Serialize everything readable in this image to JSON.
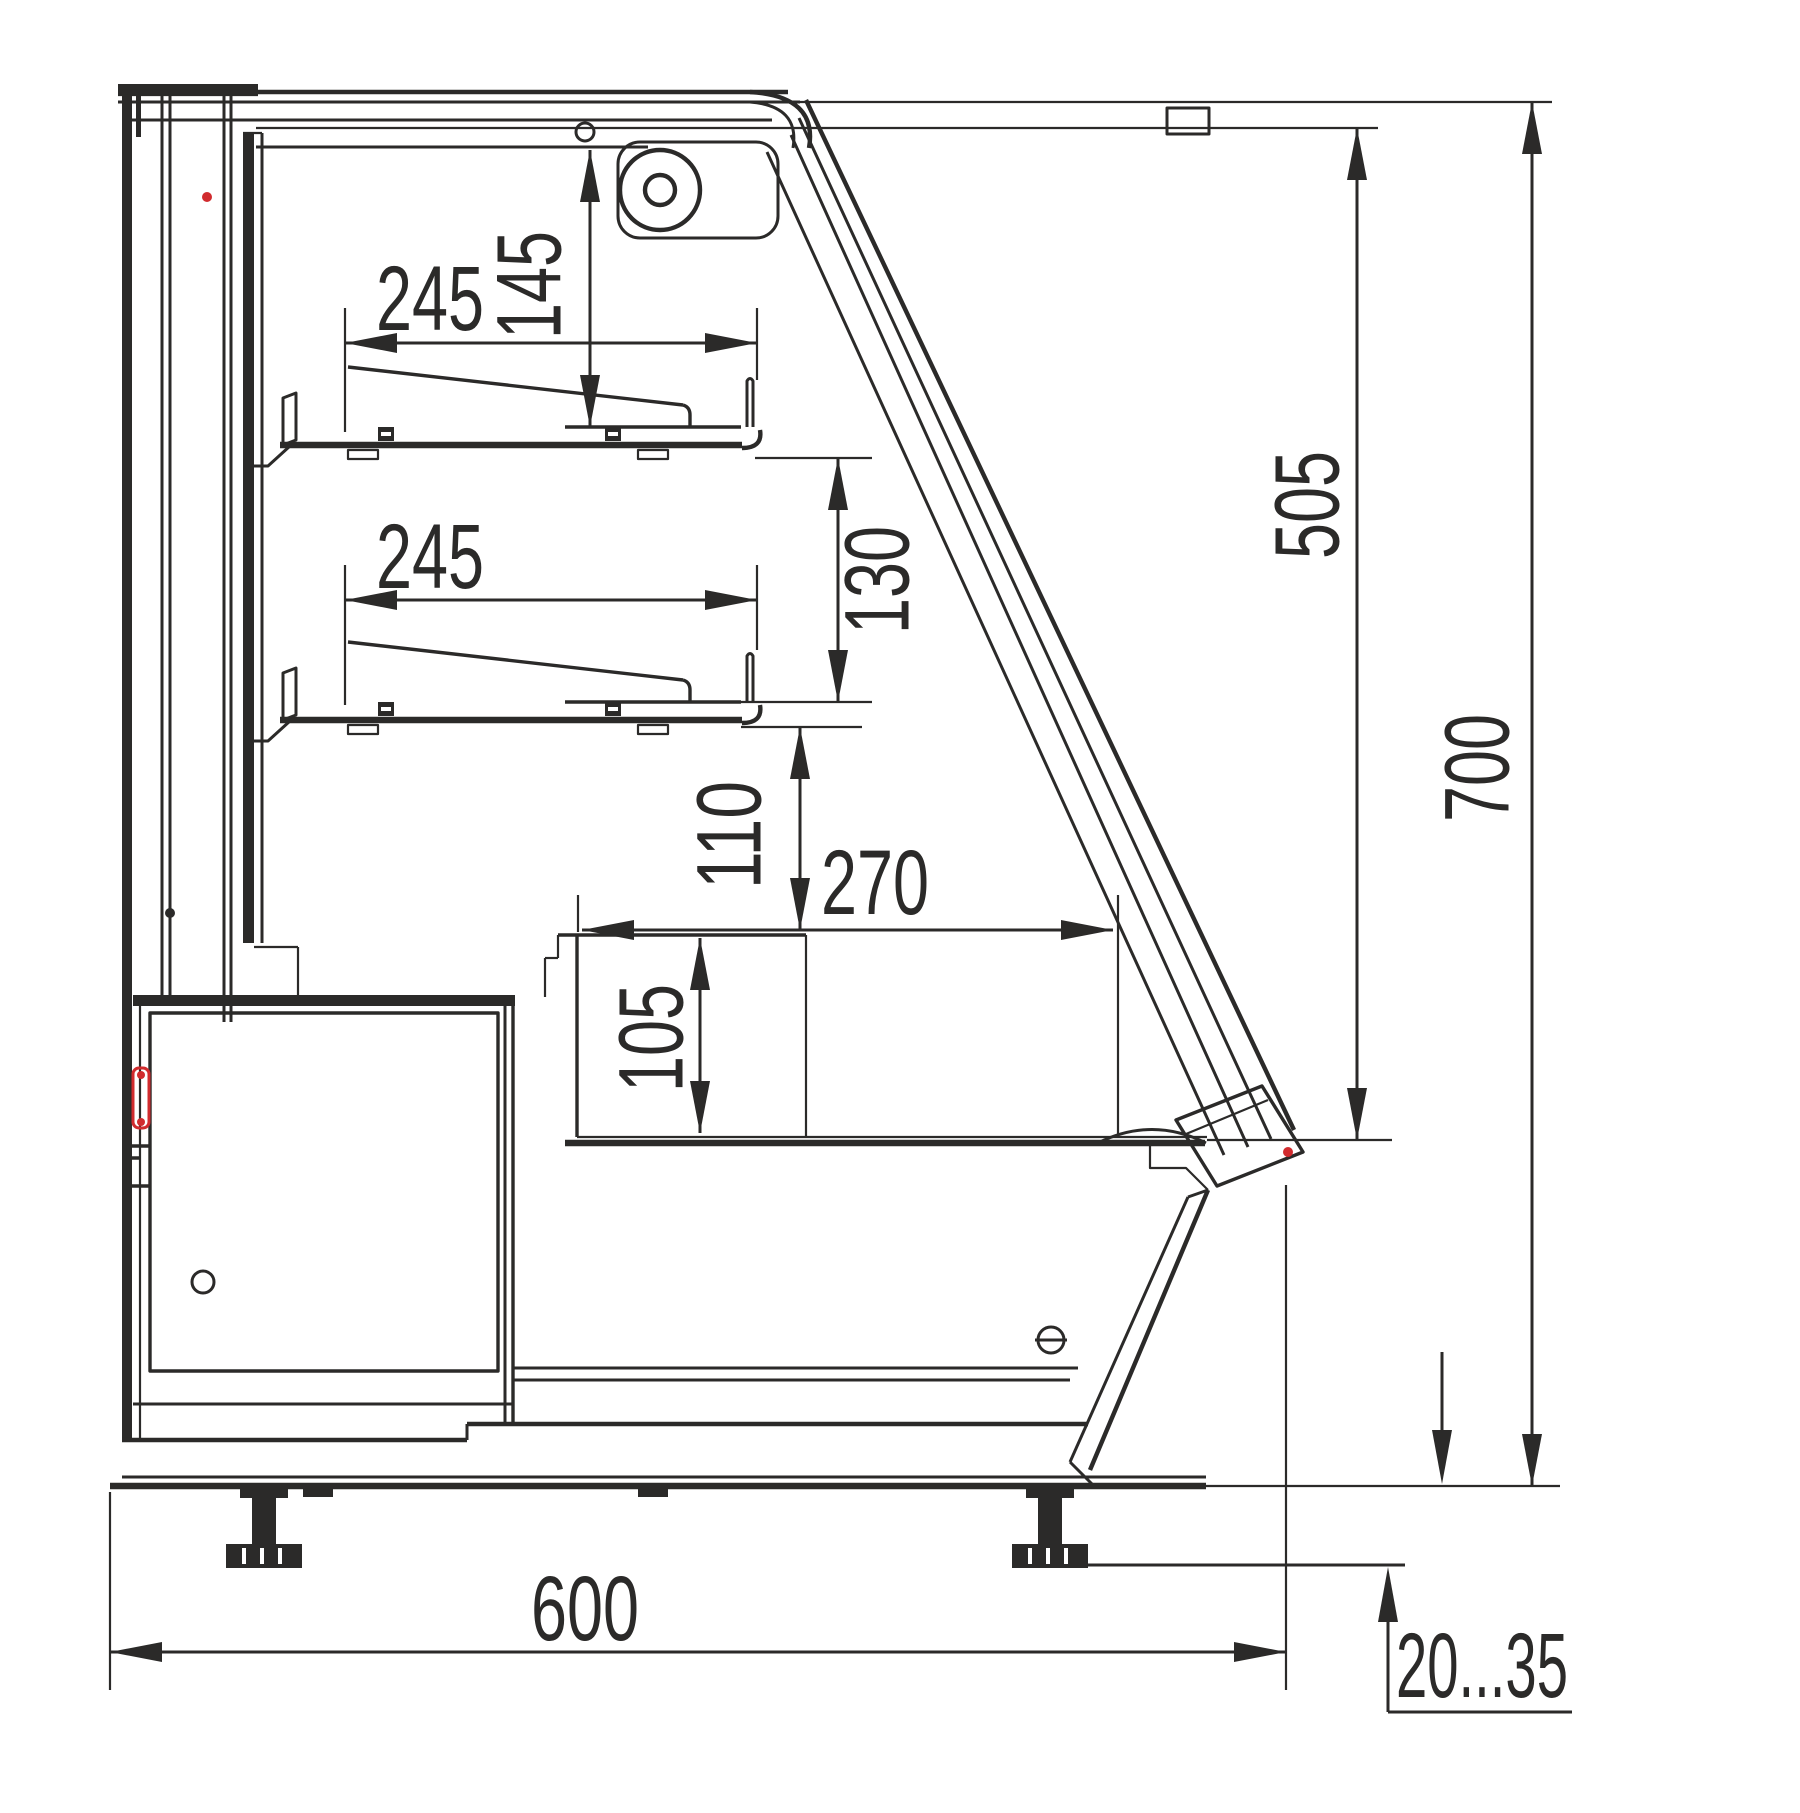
{
  "drawing": {
    "title": "display-case-side-cross-section",
    "units": "mm",
    "colors": {
      "line": "#2b2a29",
      "accent_red": "#d12b2e",
      "background": "#ffffff"
    },
    "dimensions": {
      "upper_shelf_width": "245",
      "canopy_to_upper_shelf": "145",
      "lower_shelf_width": "245",
      "shelf_spacing": "130",
      "shelf_to_well_clearance": "110",
      "well_opening_depth": "270",
      "well_depth": "105",
      "glass_to_deck_height": "505",
      "overall_height": "700",
      "overall_depth": "600",
      "foot_adjustment_range": "20...35"
    }
  }
}
